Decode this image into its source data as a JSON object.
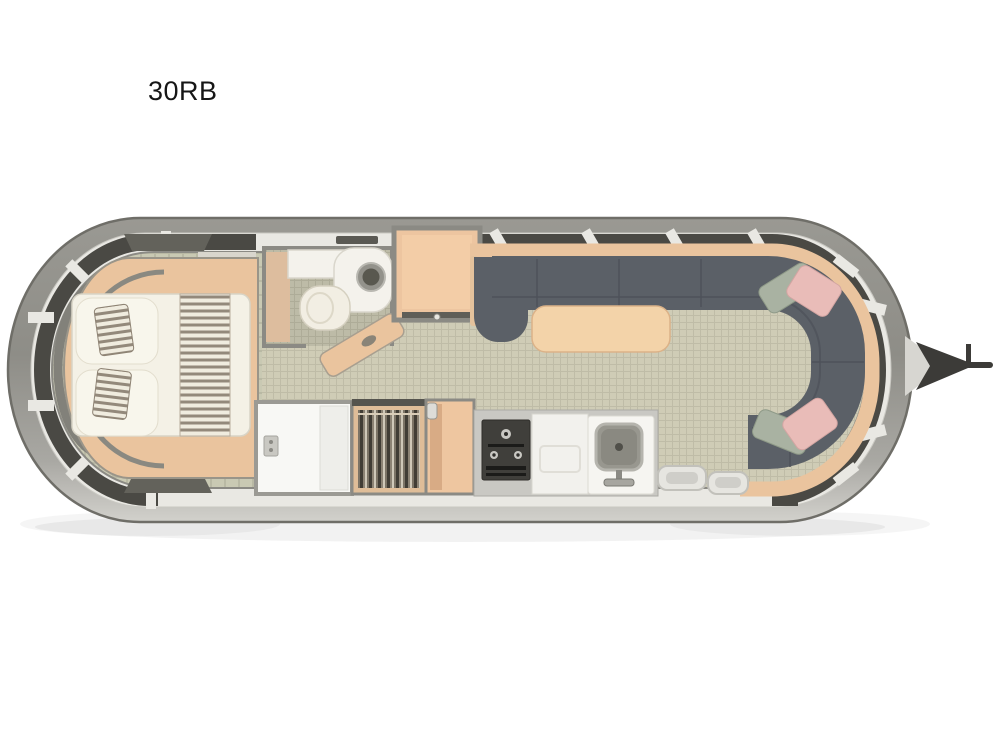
{
  "page": {
    "background": "#ffffff"
  },
  "floorplan": {
    "model_label": "30RB",
    "view": "travel-trailer top-down floor plan",
    "furniture": [
      "queen-bed",
      "overhead-vents",
      "bathroom-vanity",
      "bathroom-sink",
      "toilet",
      "bathroom-door",
      "wardrobe",
      "shower",
      "hanging-closet",
      "pantry",
      "stove",
      "kitchen-counter",
      "kitchen-sink",
      "entry-steps",
      "u-shaped-sofa",
      "dinette-table",
      "throw-pillows",
      "tongue-hitch",
      "wraparound-windows"
    ],
    "palette": {
      "shell": "#91908a",
      "shell_edge": "#6f6e68",
      "band": "#e9e8e3",
      "window": "#4a4944",
      "wall": "#8b8a84",
      "floor_tile": "#cfccb6",
      "floor_grid": "#bfbca7",
      "carpet": "#c9c9b3",
      "carpet_grid": "#b9b9a4",
      "bath_tile": "#bdbba7",
      "bath_grid": "#aeac98",
      "wood": "#eac49e",
      "sofa": "#5b6067",
      "sofa_seam": "#4d525a",
      "mattress": "#f4f1e6",
      "stripe": "#93897b",
      "stripe_light": "#f0ecdf",
      "table": "#f3d3a9",
      "pillow_pink": "#e9bcb8",
      "pillow_sage": "#a9b2a2",
      "fixture_white": "#f4f2ec",
      "steel": "#98978f",
      "hitch": "#3c3b38"
    }
  }
}
